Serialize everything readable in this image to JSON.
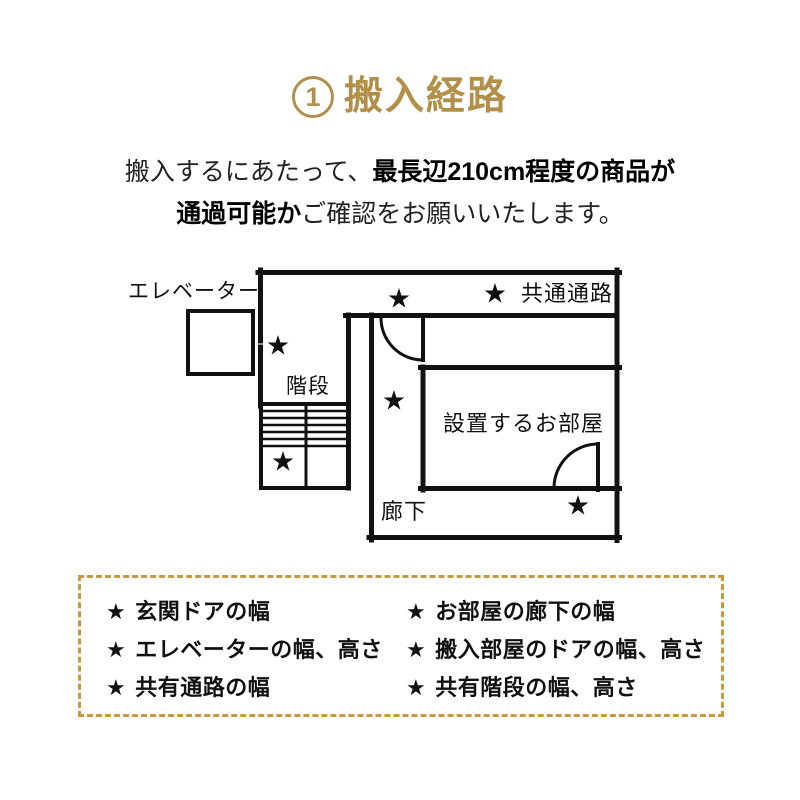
{
  "title": {
    "number": "1",
    "text": "搬入経路"
  },
  "intro": {
    "line1_regular": "搬入するにあたって、",
    "line1_bold": "最長辺210cm程度の商品が",
    "line2_bold": "通過可能か",
    "line2_regular": "ご確認をお願いいたします。"
  },
  "diagram": {
    "star": "★",
    "labels": {
      "elevator": "エレベーター",
      "stairs": "階段",
      "common_corridor": "共通通路",
      "room": "設置するお部屋",
      "hallway": "廊下"
    }
  },
  "checklist": {
    "bullet": "★",
    "left": [
      "玄関ドアの幅",
      "エレベーターの幅、高さ",
      "共有通路の幅"
    ],
    "right": [
      "お部屋の廊下の幅",
      "搬入部屋のドアの幅、高さ",
      "共有階段の幅、高さ"
    ]
  },
  "colors": {
    "accent_gold": "#b2904a",
    "dash_gold": "#c7983e",
    "line_black": "#111111"
  }
}
